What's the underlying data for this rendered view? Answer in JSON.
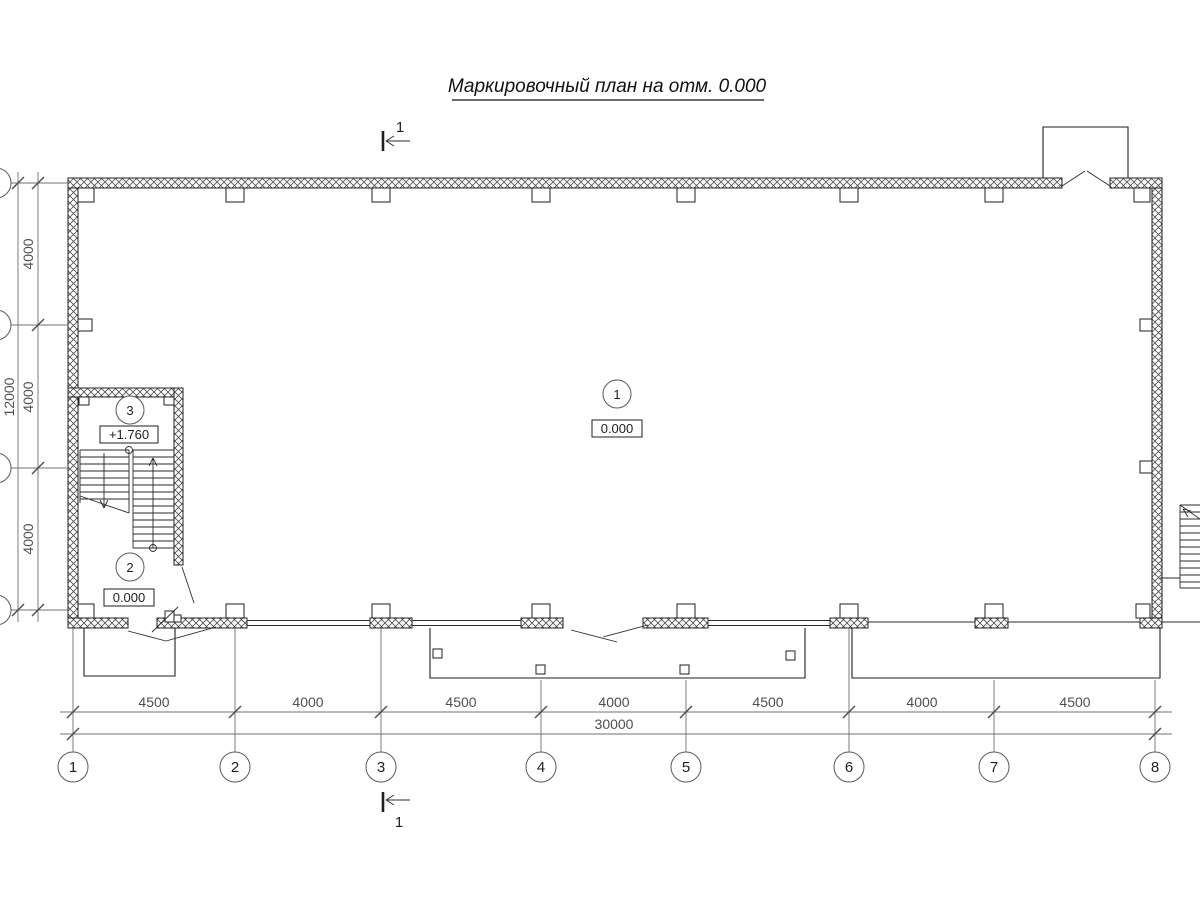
{
  "title": "Маркировочный план на отм. 0.000",
  "section_mark": {
    "top_label": "1",
    "bottom_label": "1"
  },
  "rooms": [
    {
      "number": "1",
      "level": "0.000"
    },
    {
      "number": "2",
      "level": "0.000"
    },
    {
      "number": "3",
      "level": "+1.760"
    }
  ],
  "grid": {
    "column_labels": [
      "1",
      "2",
      "3",
      "4",
      "5",
      "6",
      "7",
      "8"
    ],
    "column_dimensions": [
      "4500",
      "4000",
      "4500",
      "4000",
      "4500",
      "4000",
      "4500"
    ],
    "column_total": "30000",
    "row_dimensions": [
      "4000",
      "4000",
      "4000"
    ],
    "row_total": "12000"
  },
  "colors": {
    "line": "#1f1f1f",
    "dimension": "#707070",
    "background": "#ffffff"
  }
}
